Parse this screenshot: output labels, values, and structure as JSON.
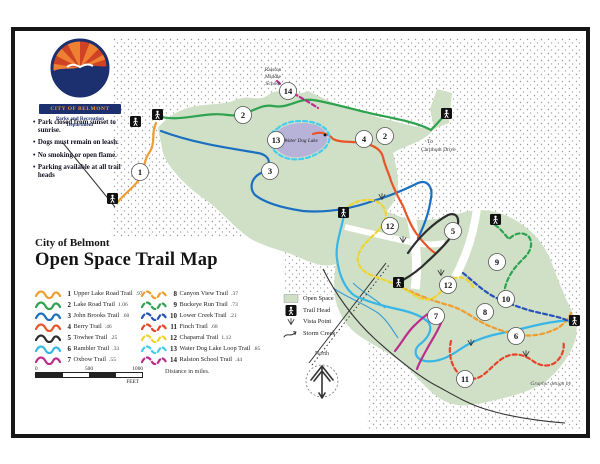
{
  "header": {
    "subtitle": "City of Belmont",
    "title": "Open Space Trail Map"
  },
  "logo": {
    "city": "CITY OF BELMONT",
    "dept1": "Parks and Recreation",
    "dept2": "Department"
  },
  "rules": [
    "Park closed from sunset to sunrise.",
    "Dogs must remain on leash.",
    "No smoking or open flame.",
    "Parking available at all trail heads"
  ],
  "legend": {
    "trails": [
      {
        "num": "1",
        "name": "Upper Lake Road Trail",
        "dist": ".97",
        "color": "#f09c2e",
        "dash": "none"
      },
      {
        "num": "2",
        "name": "Lake Road Trail",
        "dist": "1.06",
        "color": "#2ea24e",
        "dash": "none"
      },
      {
        "num": "3",
        "name": "John Brooks Trail",
        "dist": ".60",
        "color": "#1b6fc0",
        "dash": "none"
      },
      {
        "num": "4",
        "name": "Berry Trail",
        "dist": ".46",
        "color": "#e85428",
        "dash": "none"
      },
      {
        "num": "5",
        "name": "Towhee Trail",
        "dist": ".25",
        "color": "#2d2d2d",
        "dash": "none"
      },
      {
        "num": "6",
        "name": "Rambler Trail",
        "dist": ".33",
        "color": "#38b6e6",
        "dash": "none"
      },
      {
        "num": "7",
        "name": "Oxbow Trail",
        "dist": ".55",
        "color": "#bb2d8c",
        "dash": "none"
      },
      {
        "num": "8",
        "name": "Canyon View Trail",
        "dist": ".37",
        "color": "#f09c2e",
        "dash": "4 3"
      },
      {
        "num": "9",
        "name": "Buckeye Run Trail",
        "dist": ".73",
        "color": "#2ea24e",
        "dash": "4 3"
      },
      {
        "num": "10",
        "name": "Lower Creek Trail",
        "dist": ".21",
        "color": "#2852b8",
        "dash": "4 3"
      },
      {
        "num": "11",
        "name": "Finch Trail",
        "dist": ".68",
        "color": "#e84328",
        "dash": "4 3"
      },
      {
        "num": "12",
        "name": "Chaparral Trail",
        "dist": "1.12",
        "color": "#efd32f",
        "dash": "4 3"
      },
      {
        "num": "13",
        "name": "Water Dog Lake Loop Trail",
        "dist": ".85",
        "color": "#44cdee",
        "dash": "4 3"
      },
      {
        "num": "14",
        "name": "Ralston School Trail",
        "dist": ".44",
        "color": "#bb2d8c",
        "dash": "4 3"
      }
    ],
    "footnote": "Distance in miles.",
    "symbols": [
      {
        "label": "Open Space"
      },
      {
        "label": "Trail Head"
      },
      {
        "label": "Vista Point"
      },
      {
        "label": "Storm Creek"
      }
    ]
  },
  "scale": {
    "zero": "0",
    "mid": "500",
    "max": "1000",
    "unit": "FEET"
  },
  "compass": {
    "label": "North"
  },
  "map_labels": {
    "school": [
      "Ralston",
      "Middle",
      "School"
    ],
    "lake": "Water Dog Lake",
    "to_carlmont_1": "To",
    "to_carlmont_2": "Carlmont Drive",
    "credit": "Graphic design by"
  },
  "colors": {
    "open_space": "#cfe0c7",
    "lake": "#b7b2d8",
    "frame": "#161616"
  }
}
